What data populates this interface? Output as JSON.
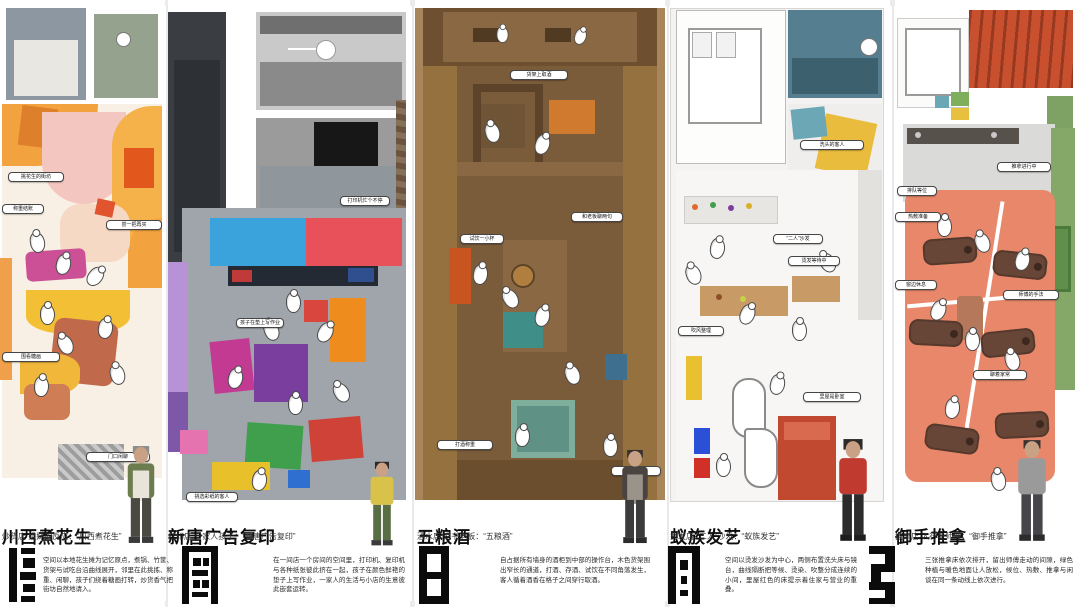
{
  "page": {
    "background": "#ffffff",
    "description_language": "zh-CN",
    "layout": "five-shop-floorplan-poster"
  },
  "sections": [
    {
      "id": "chuanxi-boiled-peanuts",
      "title": "川西煮花生",
      "subtitle": "炒货店 姐妹的反应：“川西煮花生”",
      "paragraph": "空间以本地花生摊为记忆原点，煮锅、竹筐、货架与试吃台沿曲线展开，邻里在此挑拣、称重、闲聊，孩子们绕着糖画打转，炒货香气把街坊自然地请入。",
      "annotations": [
        "挑花生的街坊",
        "称重结账",
        "尝一把再买",
        "围看糖画",
        "门口闲聊"
      ],
      "palette": {
        "floor": "#f8f0e4",
        "accent1": "#f2a23e",
        "accent2": "#f4c6c0",
        "accent3": "#cc5096",
        "accent4": "#f3c035",
        "accent5": "#c06a4b"
      }
    },
    {
      "id": "xintang-ad-copy",
      "title": "新唐广告复印",
      "subtitle": "打印店 一家人孩子：“新唐广告复印”",
      "paragraph": "在一间店一个房间的空间里，打印机、复印机与各种纸张彼此挤在一起，孩子在颜色鲜艳的垫子上写作业，一家人的生活与小店的生意彼此嵌套运转。",
      "annotations": [
        "打印机忙个不停",
        "孩子在垫上写作业",
        "挑选彩纸的客人"
      ],
      "palette": {
        "wall": "#3a3d42",
        "floor": "#9fa5ab",
        "counter_blue": "#3ba3dc",
        "counter_red": "#e8515a",
        "mat_purple": "#7a3f9e",
        "mat_green": "#3f9f4c"
      }
    },
    {
      "id": "wuliang-wine",
      "title": "五粮酒",
      "subtitle": "酒水店 说书老板：“五粮酒”",
      "paragraph": "自占据所有墙身的酒柜到中部的操作台，木色货架围出窄长的通道，打酒、存酒、试饮在不同角落发生，客人循着酒香在格子之间穿行取酒。",
      "annotations": [
        "货架上取酒",
        "和老板聊两句",
        "试饮一小杯",
        "打酒称重",
        "柜台结账"
      ],
      "palette": {
        "wood": "#a9855c",
        "wood_dark": "#6e5030",
        "floor": "#7b5c3a",
        "counter_teal": "#3f8f88",
        "accent": "#c8541f"
      }
    },
    {
      "id": "yizu-hair-art",
      "title": "蚁族发艺",
      "subtitle": "烫发店 “二人”沙发：“蚁族发艺”",
      "paragraph": "空间以烫发沙发为中心，两侧布置洗头床与镜台，曲线隔断把等候、烫染、吹整分成连续的小间，里屋红色的床提示着住家与营业的重叠。",
      "annotations": [
        "洗头的客人",
        "“二人”沙发",
        "烫发等待中",
        "吹风整理",
        "里屋是卧室"
      ],
      "palette": {
        "floor": "#f4f3f1",
        "bath_teal": "#557f90",
        "mat_yellow": "#e9bc3e",
        "wood": "#c79a66",
        "bed_red": "#c0492f"
      }
    },
    {
      "id": "yushou-massage",
      "title": "御手推拿",
      "subtitle": "按摩店 入行老师傅：“御手推拿”",
      "paragraph": "三张推拿床依次排开，留出师傅走动的间隙，绿色种植与暖色地面让人放松，候位、热敷、推拿与闲谈在同一条动线上依次进行。",
      "annotations": [
        "推拿进行中",
        "排队等位",
        "热敷准备",
        "窗边休息",
        "师傅的手法",
        "聊着家常"
      ],
      "palette": {
        "floor_salmon": "#e8876a",
        "wall_green": "#85a868",
        "table_brown": "#684637",
        "room_red": "#c8502e"
      }
    }
  ]
}
